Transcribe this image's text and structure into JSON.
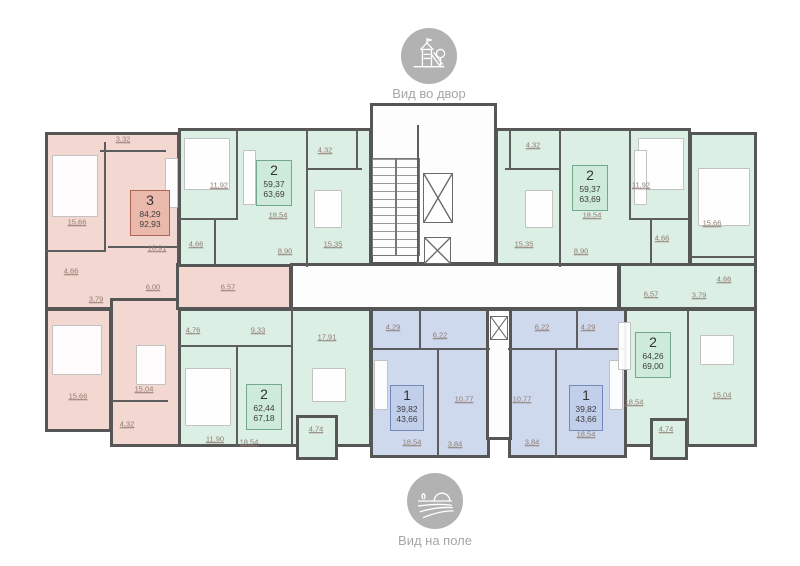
{
  "views": {
    "courtyard": {
      "caption": "Вид во двор",
      "icon": "playground-icon"
    },
    "field": {
      "caption": "Вид на поле",
      "icon": "field-icon"
    }
  },
  "apartments": [
    {
      "position": "left",
      "rooms": "3",
      "area_living": "84,29",
      "area_total": "92,93",
      "color": "pink"
    },
    {
      "position": "top-left",
      "rooms": "2",
      "area_living": "59,37",
      "area_total": "63,69",
      "color": "green"
    },
    {
      "position": "top-right",
      "rooms": "2",
      "area_living": "59,37",
      "area_total": "63,69",
      "color": "green"
    },
    {
      "position": "right",
      "rooms": "2",
      "area_living": "64,26",
      "area_total": "69,00",
      "color": "green"
    },
    {
      "position": "bottom-left",
      "rooms": "2",
      "area_living": "62,44",
      "area_total": "67,18",
      "color": "green"
    },
    {
      "position": "bottom-center-left",
      "rooms": "1",
      "area_living": "39,82",
      "area_total": "43,66",
      "color": "blue"
    },
    {
      "position": "bottom-center-right",
      "rooms": "1",
      "area_living": "39,82",
      "area_total": "43,66",
      "color": "blue"
    }
  ],
  "dims": [
    "3,32",
    "15,66",
    "16,91",
    "4,66",
    "3,79",
    "6,00",
    "6,57",
    "15,66",
    "15,04",
    "4,32",
    "11,92",
    "18,54",
    "4,66",
    "8,90",
    "4,32",
    "15,35",
    "4,32",
    "15,35",
    "18,54",
    "8,90",
    "4,66",
    "11,92",
    "15,66",
    "4,66",
    "6,57",
    "3,79",
    "18,54",
    "15,04",
    "4,74",
    "4,76",
    "9,33",
    "17,91",
    "11,90",
    "18,54",
    "4,74",
    "4,29",
    "6,22",
    "10,77",
    "18,54",
    "3,84",
    "6,22",
    "4,29",
    "10,77",
    "18,54",
    "3,84"
  ],
  "colors": {
    "wall": "#565656",
    "apartment_pink": "#f2d8d0",
    "apartment_green": "#dcefe4",
    "apartment_blue": "#cfd9ee",
    "badge_pink": "#eab9ac",
    "badge_green": "#cdeadb",
    "badge_blue": "#c2cfeb"
  }
}
